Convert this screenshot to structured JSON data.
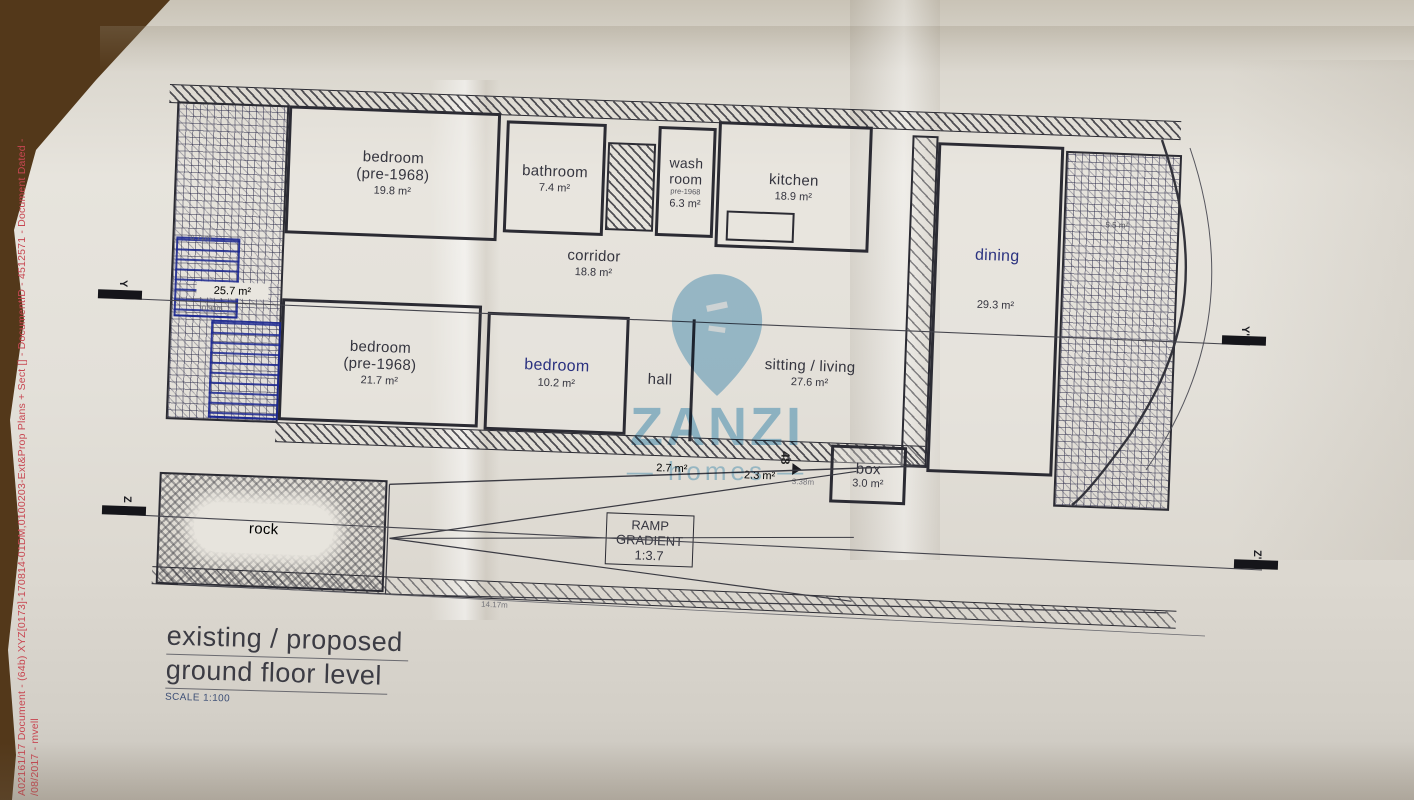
{
  "edge_note": {
    "line1": "A02161/17 Document - (64b) XYZ[0173]-170814-01DM,0100203-Ext&Prop Plans + Sect [] - DocumentID - 4512571 - Document Dated -",
    "line2": "/08/2017 - mvell"
  },
  "title_block": {
    "line1": "existing / proposed",
    "line2": "ground floor level",
    "scale": "SCALE 1:100"
  },
  "watermark": {
    "brand": "ZANZI",
    "sub": "— homes —"
  },
  "ramp": {
    "line1": "RAMP",
    "line2": "GRADIENT",
    "line3": "1:3.7"
  },
  "rooms": {
    "bedroom1": {
      "name": "bedroom",
      "name2": "(pre-1968)",
      "area": "19.8 m²"
    },
    "bathroom": {
      "name": "bathroom",
      "area": "7.4 m²"
    },
    "washroom": {
      "name": "wash",
      "name2": "room",
      "era": "pre-1968",
      "area": "6.3 m²"
    },
    "kitchen": {
      "name": "kitchen",
      "area": "18.9 m²"
    },
    "dining": {
      "name": "dining",
      "area": "29.3 m²"
    },
    "corridor": {
      "name": "corridor",
      "area": "18.8 m²"
    },
    "bedroom2": {
      "name": "bedroom",
      "name2": "(pre-1968)",
      "area": "21.7 m²"
    },
    "bedroom3": {
      "name": "bedroom",
      "area": "10.2 m²"
    },
    "hall": {
      "name": "hall"
    },
    "sitting": {
      "name": "sitting / living",
      "area": "27.6 m²"
    },
    "box": {
      "name": "box",
      "area": "3.0 m²"
    },
    "rock": {
      "name": "rock"
    },
    "yard": {
      "area": "25.7 m²"
    },
    "shaft": {
      "area": "5.5 m²"
    },
    "lobby1": {
      "area": "2.7 m²"
    },
    "lobby2": {
      "area": "2.3 m²"
    }
  },
  "dimensions": {
    "d1": "0.71m",
    "d2": "0.90m",
    "d3": "3.38m",
    "d4": "14.17m"
  },
  "sections": {
    "y": "Y",
    "y2": "Y'",
    "z": "Z",
    "z2": "Z'"
  },
  "step_count": "48"
}
